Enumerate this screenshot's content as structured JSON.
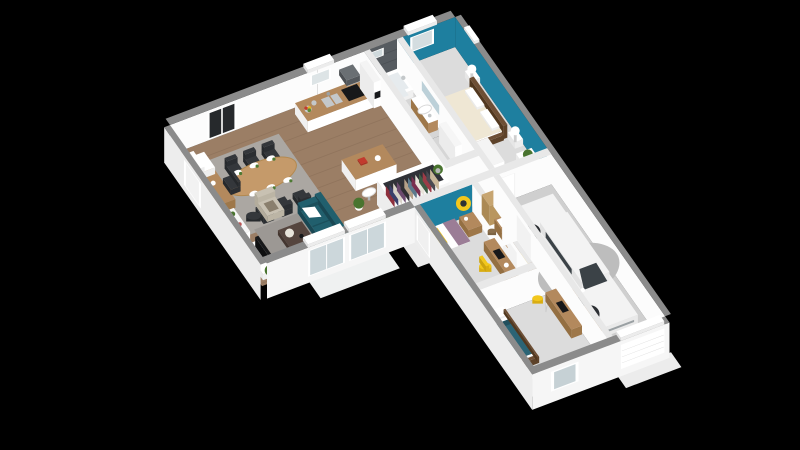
{
  "canvas": {
    "width": 800,
    "height": 450,
    "background": "#000000"
  },
  "scene": {
    "type": "3d-floorplan-render",
    "view": "isometric aerial cutaway of an L-shaped single-story house, black background",
    "rooms": [
      {
        "name": "living-dining-room",
        "floor": "wood",
        "furniture": [
          "oval-dining-table",
          "six-dark-chairs",
          "place-settings",
          "desk",
          "desk-chair",
          "lounge-chair",
          "shelf-unit",
          "tv-cabinet",
          "tv",
          "teal-sofa",
          "white-throw-pillow",
          "coffee-table",
          "armchair",
          "side-stool",
          "rugs",
          "plants",
          "bay-windows",
          "glazed-doors"
        ]
      },
      {
        "name": "kitchen",
        "floor": "wood",
        "furniture": [
          "wall-counter",
          "sink",
          "cooktop",
          "range-hood",
          "oven-column",
          "island",
          "three-bar-stools",
          "fruit-bowl",
          "window-shutter"
        ]
      },
      {
        "name": "open-wardrobe",
        "furniture": [
          "hanging-clothes",
          "plant"
        ]
      },
      {
        "name": "bathroom",
        "floor": "tile",
        "furniture": [
          "bathtub",
          "dark-tiled-wall",
          "vanity-sink",
          "mirror",
          "washing-machine"
        ]
      },
      {
        "name": "storage-room",
        "furniture": [
          "shelf-unit"
        ]
      },
      {
        "name": "master-bedroom",
        "accent": "teal-walls",
        "furniture": [
          "double-bed-cream-bedding",
          "wood-headboard",
          "two-nightstands",
          "two-sphere-lamps",
          "foot-bench",
          "wardrobe",
          "dresser",
          "plant",
          "window-shutter"
        ]
      },
      {
        "name": "wc-storage",
        "furniture": [
          "rattan-cabinet",
          "towel-cabinet",
          "basket"
        ]
      },
      {
        "name": "hallway",
        "floor": "wood",
        "furniture": [
          "yellow-rug",
          "open-doors"
        ]
      },
      {
        "name": "bedroom-2",
        "accent": "teal-walls",
        "furniture": [
          "bed-yellow-pillow",
          "mauve-throw",
          "wood-dresser",
          "round-yellow-mirror",
          "desk",
          "yellow-chair",
          "wall-shelves-books"
        ]
      },
      {
        "name": "bedroom-3",
        "furniture": [
          "bed-teal-duvet",
          "white-pillows",
          "desk",
          "yellow-stool",
          "beanbag",
          "window"
        ]
      },
      {
        "name": "garage",
        "floor": "concrete",
        "furniture": [
          "white-car",
          "workbench",
          "laundry-basket",
          "garage-door"
        ]
      }
    ],
    "palette": {
      "background": "#000000",
      "extWallTop": "#8b8b8b",
      "intWallTop": "#e8e8e8",
      "extFaceS": "#f6f6f6",
      "extFaceW": "#ededed",
      "intFace": "#fcfcfc",
      "teal": "#1e7f9f",
      "tealDark": "#1b7390",
      "sofaTeal": "#215f6d",
      "sofaTealDark": "#1b4f5b",
      "woodFloor": "#9b7e65",
      "plank": "#876b56",
      "floorLight": "#dcdcdc",
      "floorTile": "#d6d6d6",
      "floorGarage": "#cfcfcf",
      "rugGray": "#9c9894",
      "rugBeige": "#aba7a2",
      "woodMid": "#b3895d",
      "woodTable": "#c59a6a",
      "woodDark": "#6e4f35",
      "brown": "#55453e",
      "beige": "#c8c1b2",
      "charcoal": "#34373b",
      "black": "#17181a",
      "glass": "#ccd7db",
      "winDark": "#26292c",
      "yellow": "#f2c71d",
      "green": "#49742f",
      "rattan": "#c7a571",
      "cream": "#efe7d4",
      "mauve": "#9b7d96",
      "tealDuvet": "#2b6475",
      "car": "#f3f3f3",
      "carSide": "#dfdfdf",
      "carGlass": "#3b4247",
      "red": "#b43a2e",
      "silver": "#c4c8ca",
      "white": "#ffffff",
      "tileWall": "#565b60",
      "recess": "#303238",
      "clothes": [
        "#8d2f3c",
        "#3a3f6b",
        "#d9d3c8",
        "#6b4a6e",
        "#2f2f33",
        "#b5a188",
        "#5d7a8c",
        "#7a2f4f",
        "#e8e4da",
        "#3d5c45",
        "#9b3b46",
        "#4a4a52",
        "#c9b79a"
      ]
    }
  }
}
